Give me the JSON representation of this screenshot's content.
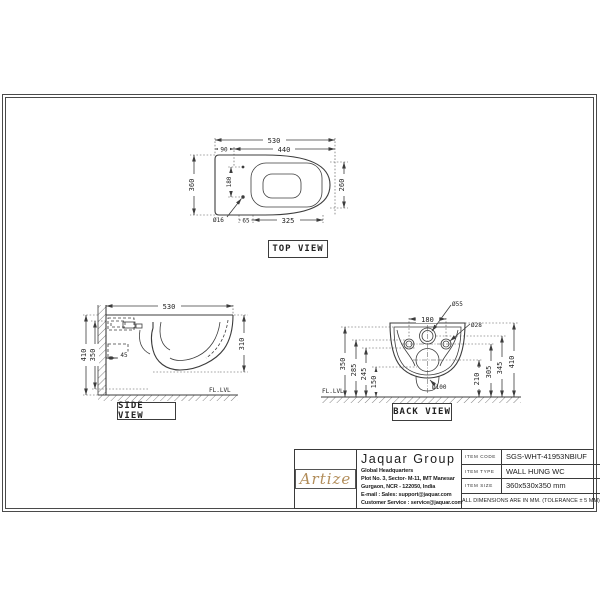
{
  "views": {
    "top": {
      "title": "TOP VIEW",
      "dims": {
        "d530": "530",
        "d440": "440",
        "d90": "90",
        "d360": "360",
        "d180": "180",
        "d260": "260",
        "d325": "325",
        "d65": "65",
        "dia16": "Ø16"
      }
    },
    "side": {
      "title": "SIDE VIEW",
      "floor": "FL.LVL",
      "dims": {
        "d530": "530",
        "d410": "410",
        "d350": "350",
        "d310": "310",
        "d45": "45"
      }
    },
    "back": {
      "title": "BACK VIEW",
      "floor": "FL.LVL",
      "dims": {
        "d180": "180",
        "dia55": "Ø55",
        "dia28": "Ø28",
        "dia100": "Ø100",
        "d350": "350",
        "d285": "285",
        "d245": "245",
        "d150": "150",
        "d210": "210",
        "d305": "305",
        "d345": "345",
        "d410": "410"
      }
    }
  },
  "title_block": {
    "brand": "Artize",
    "brand_color": "#b28d5a",
    "company": "Jaquar Group",
    "address": [
      "Global Headquarters",
      "Plot No. 3, Sector- M-11, IMT Manesar",
      "Gurgaon, NCR - 122050, India",
      "E-mail : Sales: support@jaquar.com",
      "Customer Service : service@jaquar.com"
    ],
    "items": [
      {
        "label": "ITEM CODE",
        "value": "SGS-WHT-41953NBIUF"
      },
      {
        "label": "ITEM TYPE",
        "value": "WALL HUNG WC"
      },
      {
        "label": "ITEM SIZE",
        "value": "360x530x350 mm"
      }
    ],
    "note": "ALL DIMENSIONS ARE IN MM. (TOLERANCE ± 5 MM)"
  }
}
